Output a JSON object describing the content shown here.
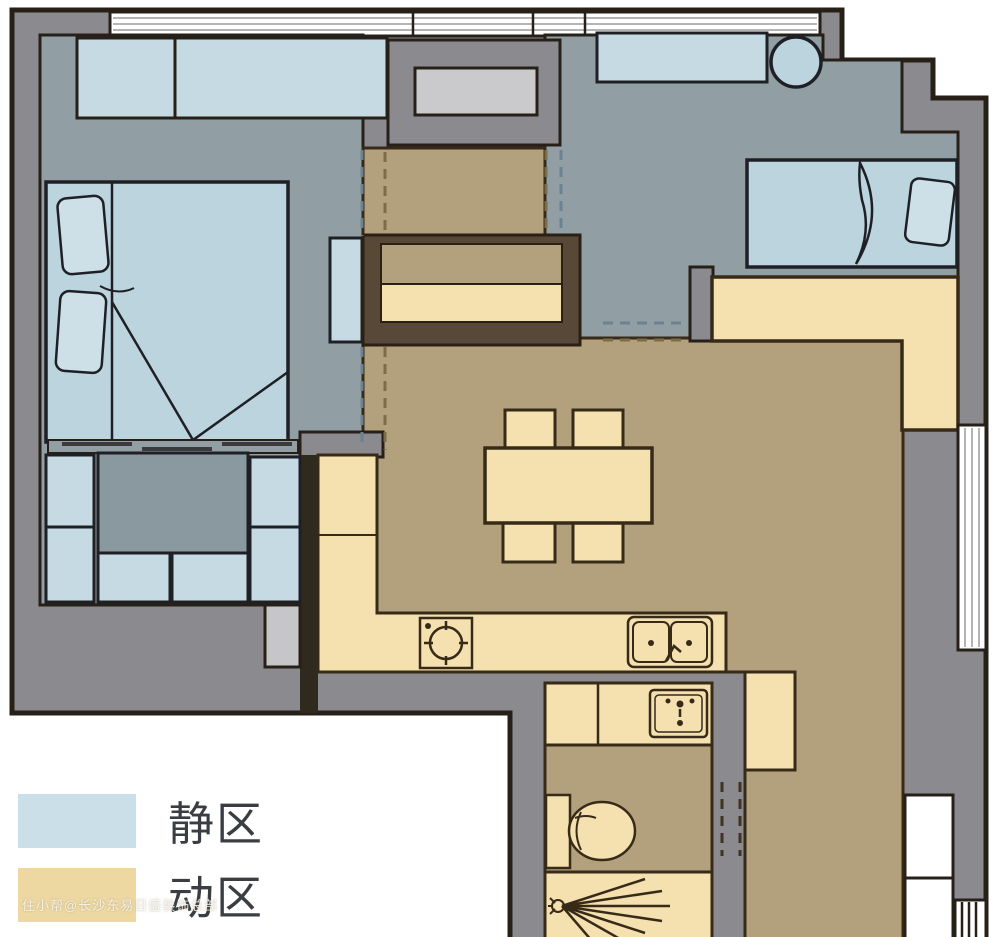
{
  "legend": {
    "items": [
      {
        "label": "静区",
        "color": "#cadfe8"
      },
      {
        "label": "动区",
        "color": "#edd8a2"
      }
    ]
  },
  "watermark": "住小帮@长沙东易日盛装饰总部",
  "colors": {
    "wall": "#8b8a8e",
    "quiet_floor": "#919ea4",
    "active_floor": "#b2a17c",
    "furniture_blue": "#bcd4de",
    "cabinet_blue": "#c6dae3",
    "furniture_cream": "#f5e0b0",
    "outline_dark": "#262019",
    "outline_warm": "#372b18",
    "appliance_gray": "#cacacc",
    "dark_wall": "#30291e",
    "entry_cabinet": "#584838",
    "dash_blue": "#6d8290",
    "dash_brown": "#7d6c46",
    "window_line": "#9b9b9b"
  },
  "icons": [
    "double-bed-icon",
    "single-bed-icon",
    "pillow-icon",
    "desk-icon",
    "stool-icon",
    "tatami-storage-icon",
    "dining-table-icon",
    "chair-icon",
    "stove-icon",
    "sink-icon",
    "washbasin-icon",
    "toilet-icon",
    "shower-icon",
    "window-icon",
    "door-icon"
  ]
}
